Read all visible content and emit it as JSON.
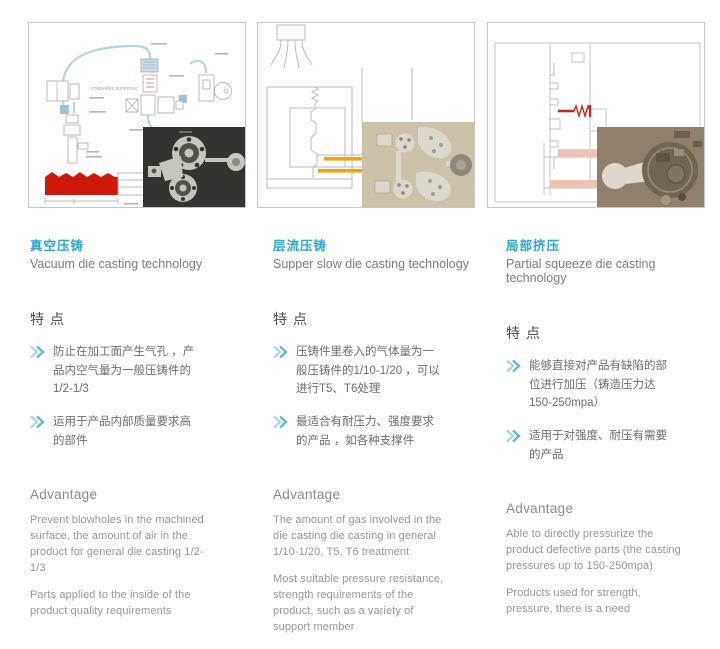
{
  "page": {
    "background": "#ffffff"
  },
  "colors": {
    "accent_cyan": "#2fa5c9",
    "chevron_blue_outer": "#a7d8e8",
    "chevron_blue_inner": "#5fb7d4",
    "features_heading_gray": "#4e4e4e",
    "feature_text_gray": "#6d6d6d",
    "advantage_text_gray": "#979797",
    "panel_border": "#c6c6c6",
    "diagram_pipe_blue": "#b7d3df",
    "diagram_line_gray": "#bbbbbb",
    "molten_metal_red": "#ce1a0e",
    "shot_sleeve_yellow": "#f2a50a",
    "squeeze_pin_red": "#c42a1c",
    "squeeze_pad_pink": "#eec3b6"
  },
  "icons": {
    "feature_bullet": "double-chevron-right"
  },
  "columns": [
    {
      "title_zh": "真空压铸",
      "title_en": "Vacuum die casting technology",
      "features_heading": "特点",
      "features": [
        "防止在加工面产生气孔 ，产品内空气量为一般压铸件的1/2-1/3",
        "运用于产品内部质量要求高的部件"
      ],
      "advantage_heading": "Advantage",
      "advantages": [
        "Prevent blowholes in the machined surface, the amount of air in the product for general die casting 1/2-1/3",
        "Parts applied to the inside of the product quality requirements"
      ],
      "diagram_label": "FONDAREX SUPERVAC"
    },
    {
      "title_zh": "层流压铸",
      "title_en": "Supper slow die casting technology",
      "features_heading": "特点",
      "features": [
        "压铸件里卷入的气体量为一般压铸件的1/10-1/20 ，可以进行T5、T6处理",
        "最适合有耐压力、强度要求的产品 ，如各种支撑件"
      ],
      "advantage_heading": "Advantage",
      "advantages": [
        "The amount of gas involved in the die casting die casting in general 1/10-1/20, T5, T6 treatment",
        "Most suitable pressure resistance, strength requirements of the product, such as a variety of support member"
      ]
    },
    {
      "title_zh": "局部挤压",
      "title_en": "Partial squeeze die casting technology",
      "features_heading": "特点",
      "features": [
        "能够直接对产品有缺陷的部位进行加压（铸造压力达150-250mpa）",
        "适用于对强度、耐压有需要的产品"
      ],
      "advantage_heading": "Advantage",
      "advantages": [
        "Able to directly pressurize the product defective parts (the casting pressures up to 150-250mpa)",
        "Products used for strength, pressure, there is a need"
      ]
    }
  ]
}
